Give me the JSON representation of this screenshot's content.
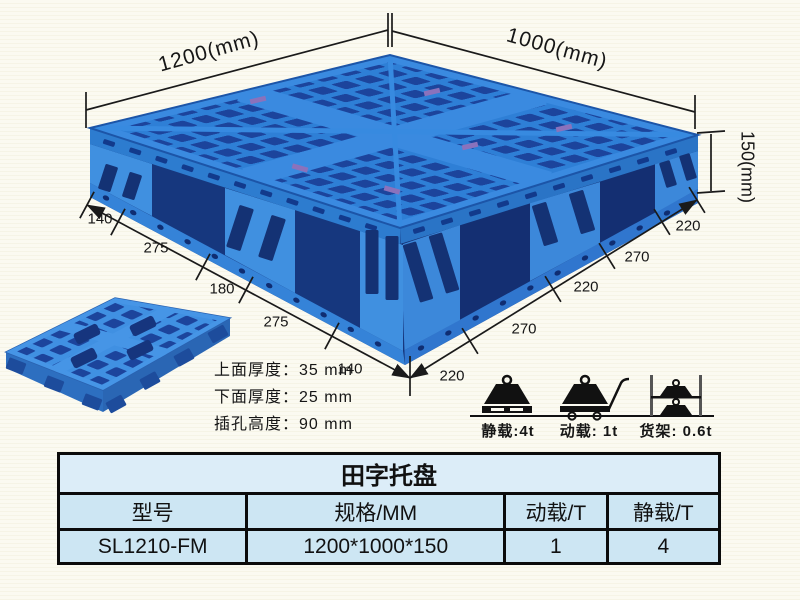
{
  "colors": {
    "background": "#fbfaf1",
    "pallet_blue": "#2e7fd6",
    "pallet_hole_dark": "#1c449c",
    "pallet_band_light": "#3a8ae0",
    "dimension_ink": "#1a1a1a",
    "table_border": "#0b0b0b",
    "table_cell_bg": "#cde6f3",
    "table_title_bg": "#dcedf8"
  },
  "diagram": {
    "dim_width": "1200(mm)",
    "dim_depth": "1000(mm)",
    "dim_height": "150(mm)",
    "left_chain": [
      "140",
      "275",
      "180",
      "275",
      "140"
    ],
    "right_chain": [
      "220",
      "270",
      "220",
      "270",
      "220"
    ],
    "notes": [
      "上面厚度：35 mm",
      "下面厚度：25 mm",
      "插孔高度：90 mm"
    ],
    "loads": [
      {
        "icon": "static-load-icon",
        "label": "静载:4t"
      },
      {
        "icon": "dynamic-load-icon",
        "label": "动载: 1t"
      },
      {
        "icon": "rack-load-icon",
        "label": "货架: 0.6t"
      }
    ]
  },
  "table": {
    "title": "田字托盘",
    "headers": [
      "型号",
      "规格/MM",
      "动载/T",
      "静载/T"
    ],
    "rows": [
      [
        "SL1210-FM",
        "1200*1000*150",
        "1",
        "4"
      ]
    ]
  }
}
